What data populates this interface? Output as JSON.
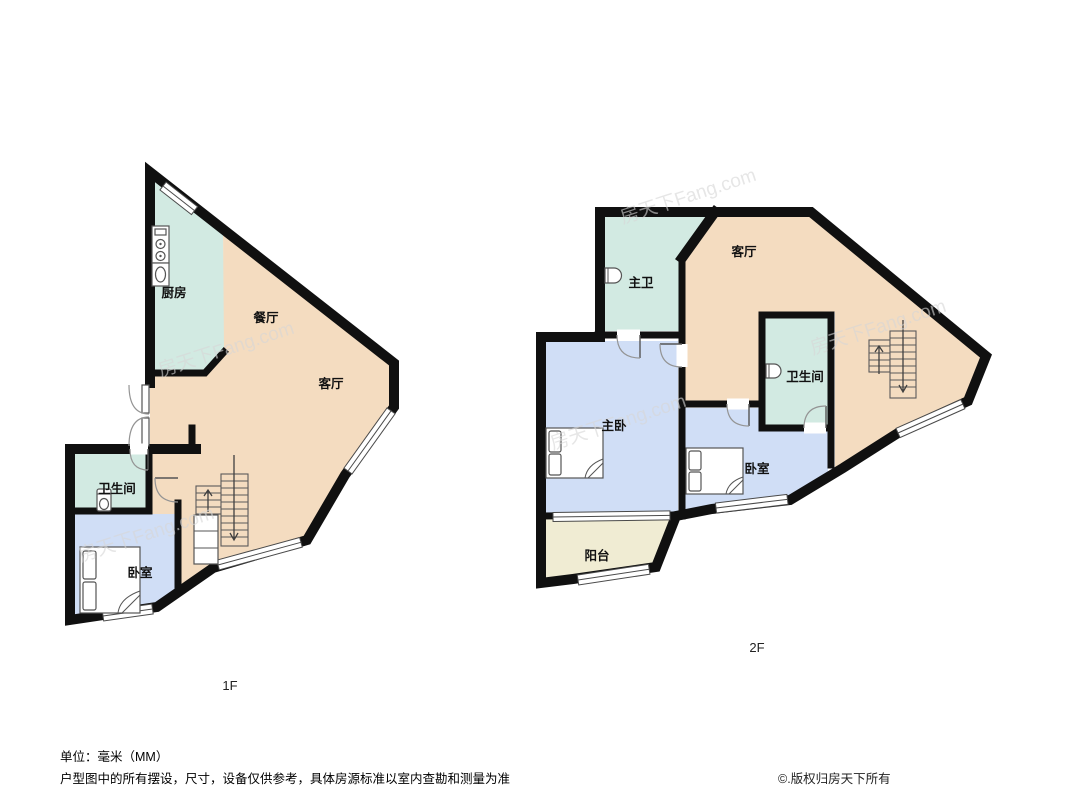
{
  "floor1": {
    "label": "1F",
    "rooms": {
      "kitchen": "厨房",
      "dining": "餐厅",
      "living": "客厅",
      "bathroom": "卫生间",
      "bedroom": "卧室"
    }
  },
  "floor2": {
    "label": "2F",
    "rooms": {
      "master_bath": "主卫",
      "living": "客厅",
      "bathroom": "卫生间",
      "master_bedroom": "主卧",
      "bedroom": "卧室",
      "balcony": "阳台"
    }
  },
  "footer": {
    "unit": "单位：毫米（MM）",
    "disclaimer": "户型图中的所有摆设，尺寸，设备仅供参考，具体房源标准以室内查勘和测量为准",
    "copyright": "©.版权归房天下所有"
  },
  "watermark": "房天下Fang.com",
  "colors": {
    "wall": "#101010",
    "wet": "#d2eae2",
    "living": "#f4dcc0",
    "bedroom": "#d0def6",
    "balcony": "#f0ecd3"
  }
}
